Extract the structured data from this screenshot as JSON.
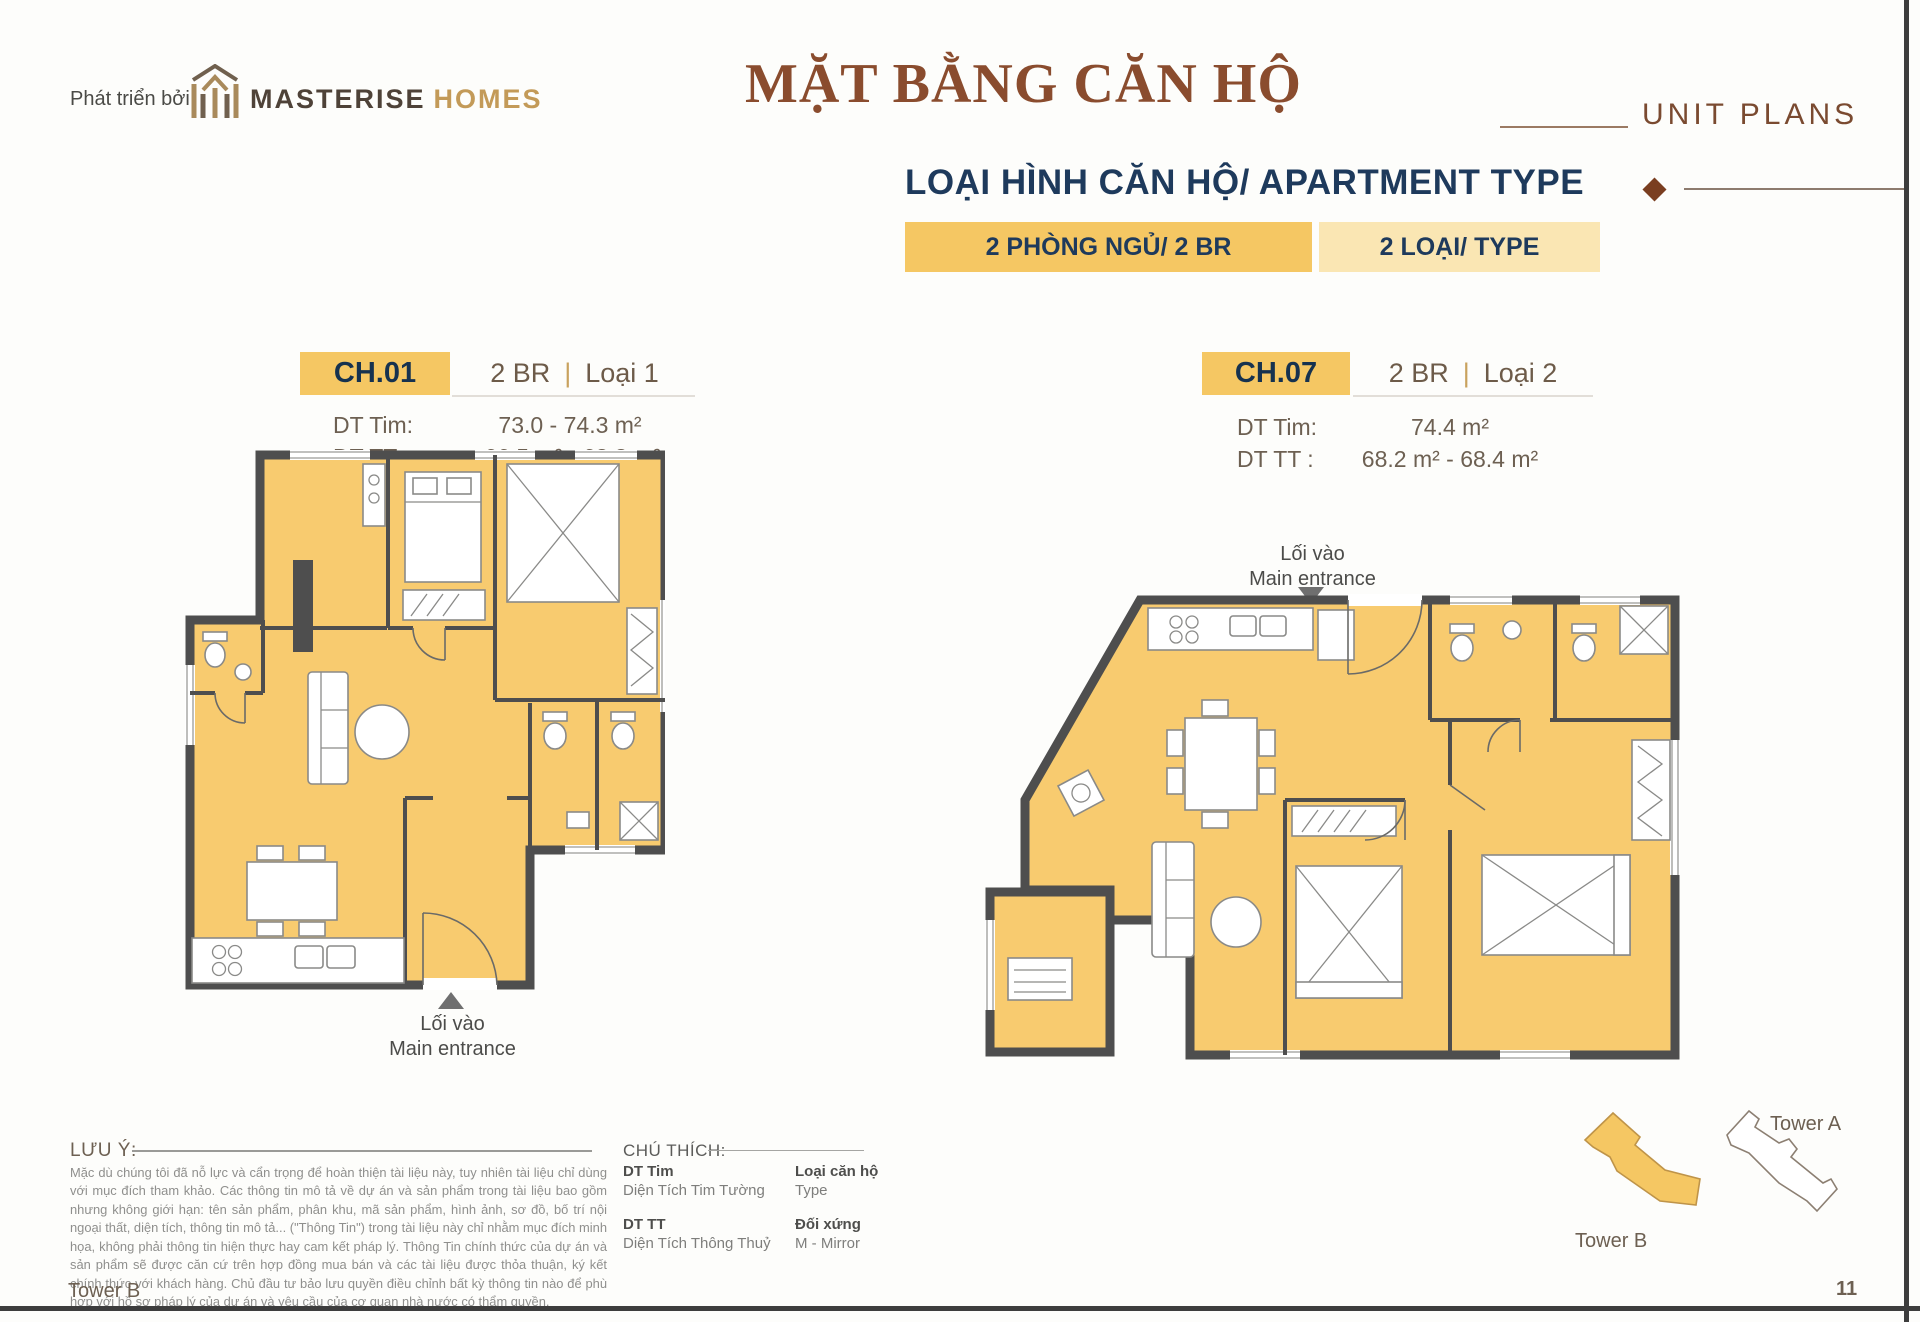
{
  "header": {
    "developer_label": "Phát triển bởi",
    "brand_primary": "MASTERISE",
    "brand_secondary": "HOMES",
    "title_vi": "MẶT BẰNG CĂN HỘ",
    "title_en": "UNIT PLANS",
    "subtitle": "LOẠI HÌNH CĂN HỘ/ APARTMENT TYPE",
    "badge_rooms": "2 PHÒNG NGỦ/ 2 BR",
    "badge_types": "2 LOẠI/ TYPE"
  },
  "units": [
    {
      "code": "CH.01",
      "bed_type": "2 BR",
      "divider": "|",
      "variant": "Loại 1",
      "dt_tim_label": "DT Tim:",
      "dt_tim_value": "73.0 - 74.3 m²",
      "dt_tt_label": "DT TT :",
      "dt_tt_value": "66.5 m² - 68.8 m²",
      "entrance_vi": "Lối vào",
      "entrance_en": "Main entrance"
    },
    {
      "code": "CH.07",
      "bed_type": "2 BR",
      "divider": "|",
      "variant": "Loại 2",
      "dt_tim_label": "DT Tim:",
      "dt_tim_value": "74.4 m²",
      "dt_tt_label": "DT TT :",
      "dt_tt_value": "68.2 m² - 68.4 m²",
      "entrance_vi": "Lối vào",
      "entrance_en": "Main entrance"
    }
  ],
  "notes": {
    "label": "LƯU Ý:",
    "body": "Mặc dù chúng tôi đã nỗ lực và cẩn trọng để hoàn thiện tài liệu này, tuy nhiên tài liệu chỉ dùng với mục đích tham khảo. Các thông tin mô tả về dự án và sản phẩm trong tài liệu bao gồm nhưng không giới hạn: tên sản phẩm, phân khu, mã sản phẩm, hình ảnh, sơ đồ, bố trí nội ngoại thất, diện tích, thông tin mô tả... (\"Thông Tin\") trong tài liệu này chỉ nhằm mục đích minh họa, không phải thông tin hiện thực hay cam kết pháp lý. Thông Tin chính thức của dự án và sản phẩm sẽ được căn cứ trên hợp đồng mua bán và các tài liệu được thỏa thuận, ký kết chính thức với khách hàng. Chủ đầu tư bảo lưu quyền điều chỉnh bất kỳ thông tin nào để phù hợp với hồ sơ pháp lý của dự án và yêu cầu của cơ quan nhà nước có thẩm quyền."
  },
  "legend": {
    "label": "CHÚ THÍCH:",
    "items": [
      {
        "term": "DT Tim",
        "definition": "Diện Tích Tim Tường"
      },
      {
        "term": "Loại căn hộ",
        "definition": "Type"
      },
      {
        "term": "DT TT",
        "definition": "Diện Tích Thông Thuỷ"
      },
      {
        "term": "Đối xứng",
        "definition": "M - Mirror"
      }
    ]
  },
  "site_map": {
    "tower_a_label": "Tower A",
    "tower_b_label": "Tower B"
  },
  "footer": {
    "tower_label": "Tower B",
    "page_number": "11"
  },
  "colors": {
    "accent_brown": "#8A4C2E",
    "navy": "#1E3A5C",
    "badge_gold": "#F5C763",
    "badge_light": "#FAE6B3",
    "plan_fill": "#F8CB6F",
    "wall_gray": "#4E4E4E"
  }
}
